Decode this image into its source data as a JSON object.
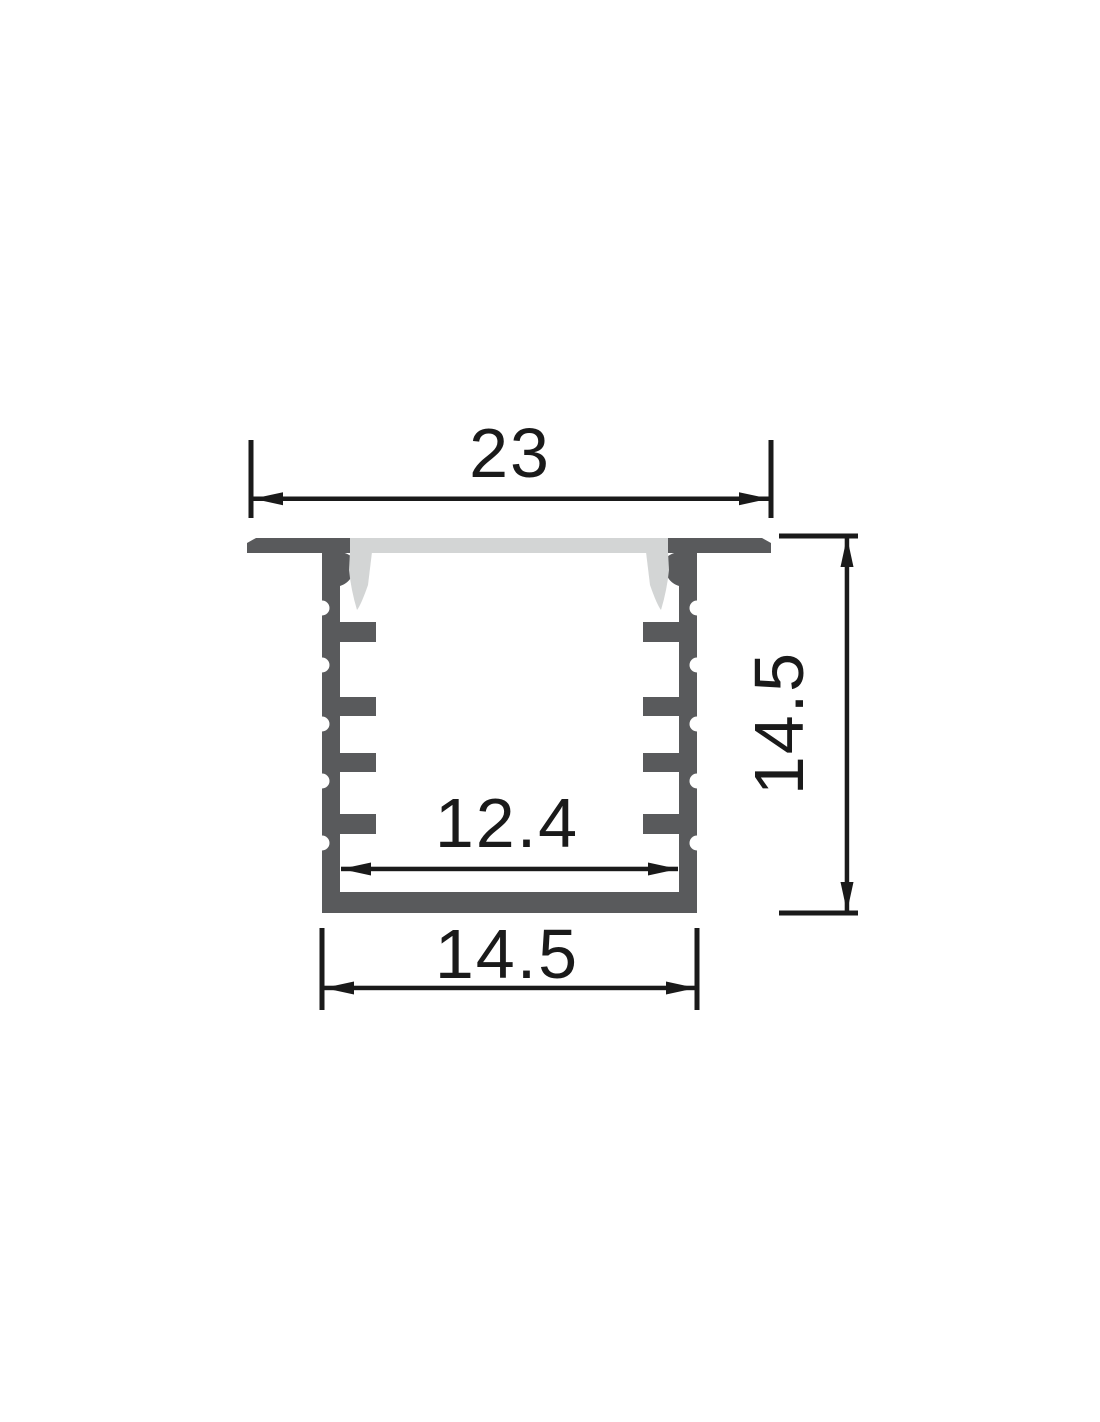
{
  "drawing": {
    "type": "technical-cross-section",
    "subject": "recessed-led-aluminum-profile",
    "colors": {
      "background": "#ffffff",
      "profile": "#595a5c",
      "diffuser": "#d3d5d5",
      "dimension": "#1a1a1a"
    },
    "dimensions": {
      "top_width": {
        "value": "23",
        "orientation": "horizontal",
        "position": "top"
      },
      "height": {
        "value": "14.5",
        "orientation": "vertical",
        "position": "right"
      },
      "inner_width": {
        "value": "12.4",
        "orientation": "horizontal",
        "position": "inside-channel"
      },
      "body_width": {
        "value": "14.5",
        "orientation": "horizontal",
        "position": "bottom"
      }
    }
  }
}
